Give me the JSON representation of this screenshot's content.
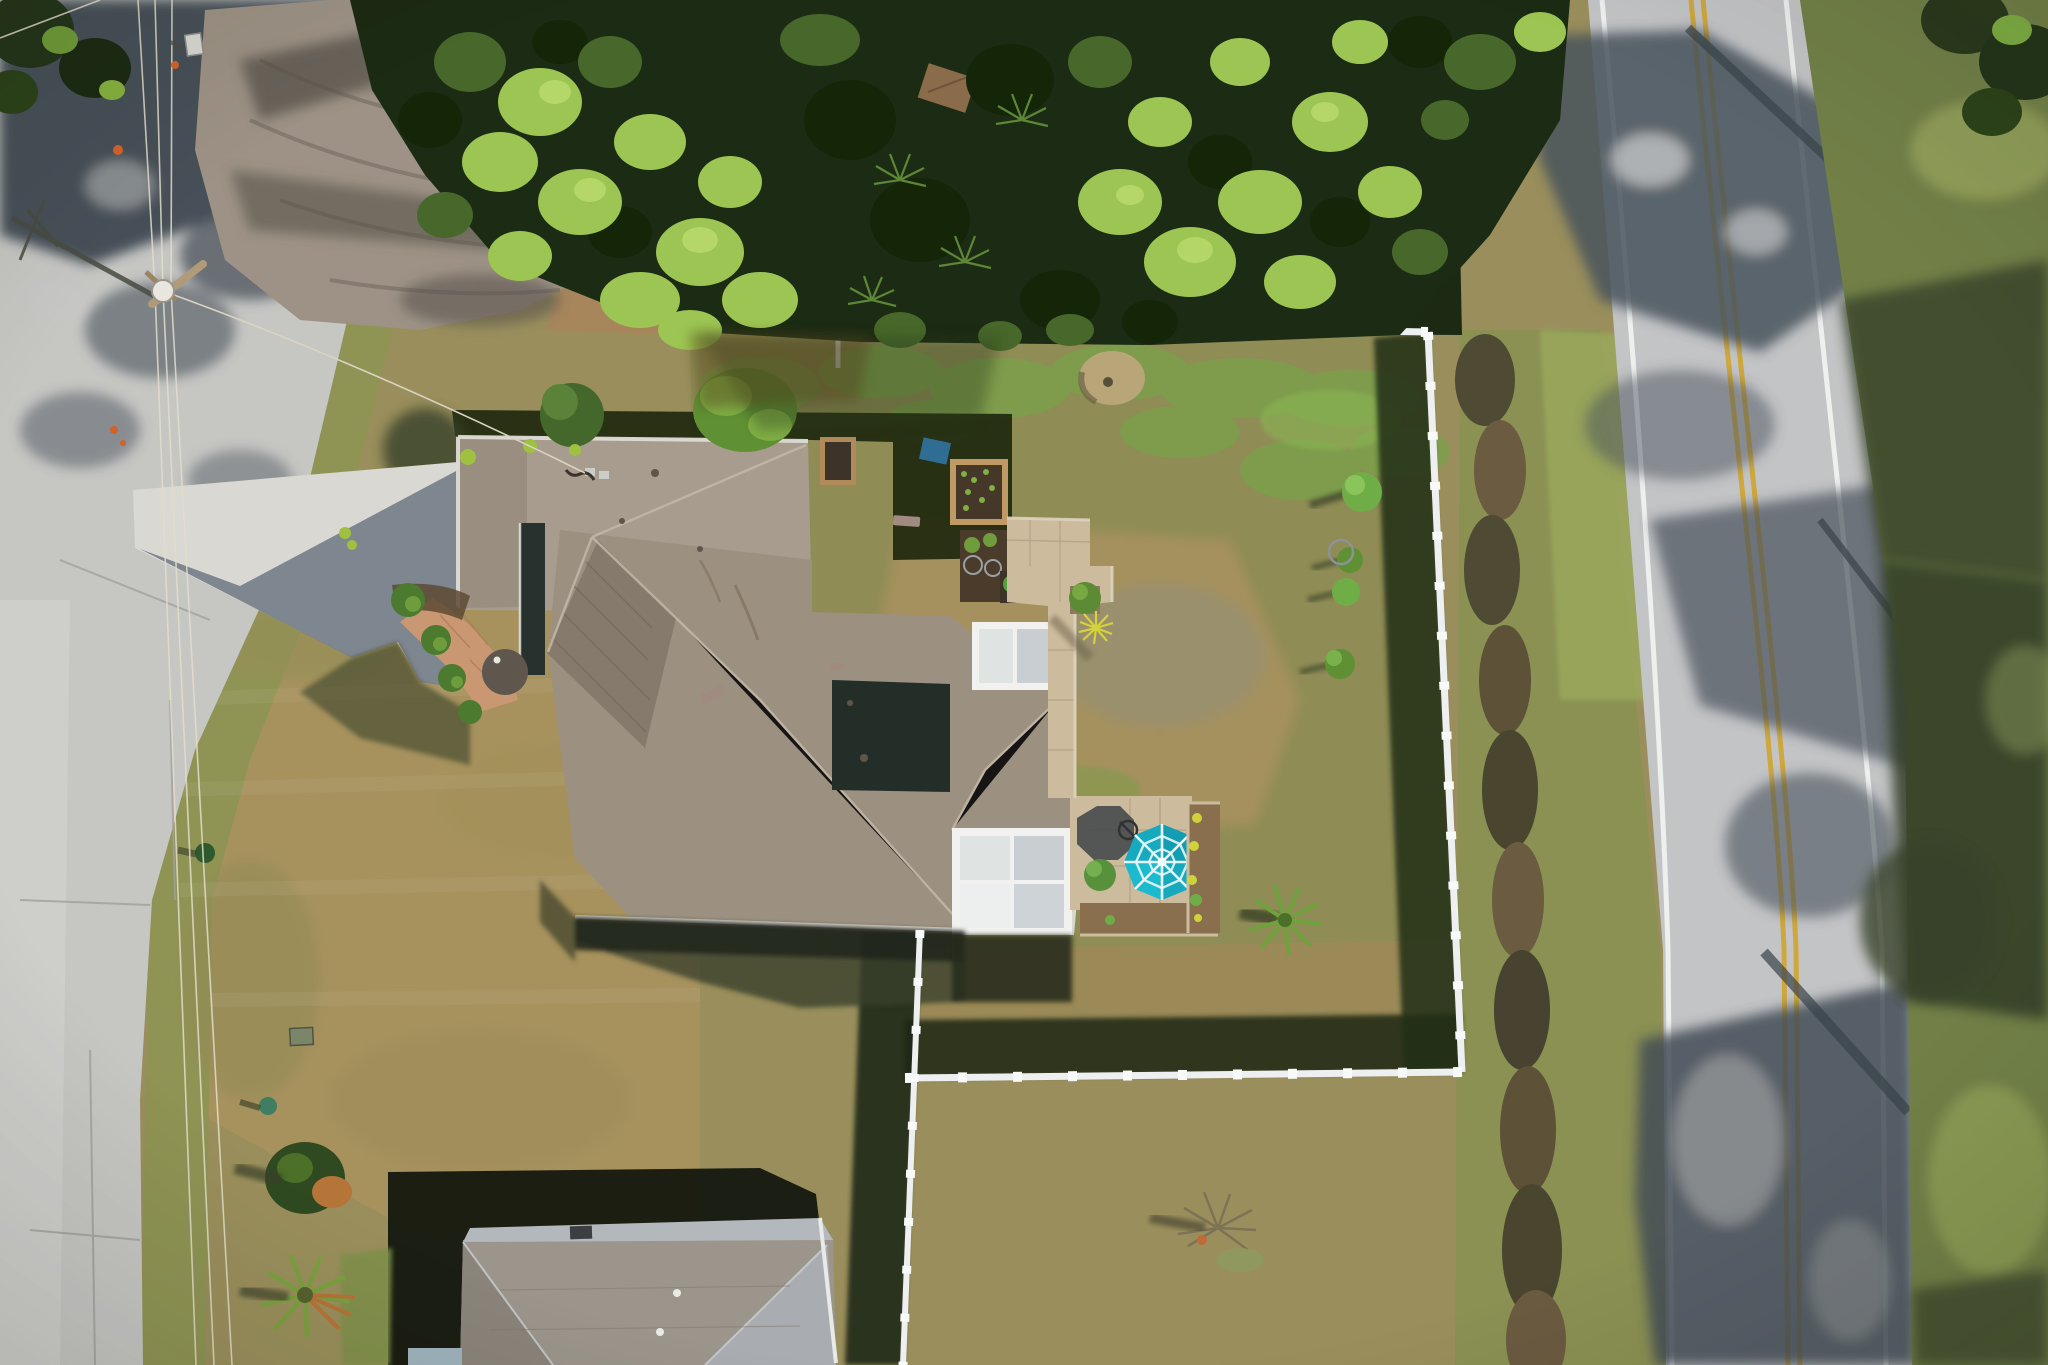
{
  "meta": {
    "kind": "aerial-drone-photo",
    "description": "Top-down aerial photo of a single-family home with tan shingle hip roof, concrete driveway to a road on the left, white vinyl-fenced backyard with paver patio and teal umbrella, dense pine/palmetto trees at top, and a second road with double yellow centerline on the right; neighboring house roof at bottom.",
    "width_px": 2048,
    "height_px": 1365
  },
  "palette": {
    "lawn_base": "#9a8f5c",
    "lawn_tan": "#a8925f",
    "lawn_olive": "#8f9454",
    "lawn_green": "#7ba04b",
    "asphalt_left": "#c6c6c3",
    "asphalt_right": "#c3c4c6",
    "road_shadow": "#49535c",
    "line_white": "#eef0ee",
    "line_yellow": "#cfa83d",
    "dirt": "#9d9285",
    "canopy_dark": "#1c2b13",
    "canopy_mid": "#47682a",
    "canopy_bright": "#9cc553",
    "roof_main": "#a79c8d",
    "roof_west": "#998e80",
    "roof_dark": "#857a6c",
    "roof_south": "#9c9081",
    "gutter": "#dcdcd6",
    "driveway": "#d9d8d2",
    "driveway_shadow": "#79828c",
    "fence": "#edeff0",
    "shadow_deep": "#11160d",
    "lanai_frame": "#f1f2f0",
    "lanai_panel": "#c9ced2",
    "paver": "#cdbb9d",
    "soil": "#8a6f4e",
    "umbrella_teal": "#17aabf",
    "neighbor_roof": "#9b958b",
    "neighbor_roof_north": "#b3b8bc"
  },
  "scene": {
    "roads": [
      {
        "name": "left-road",
        "orientation": "vertical-diagonal",
        "markings": "none",
        "condition": "cracked asphalt, tree shadows at top, utility pole shadow"
      },
      {
        "name": "right-road",
        "orientation": "vertical-diagonal",
        "markings": "double yellow centerline, white edge lines",
        "condition": "heavy tree shadows from east"
      }
    ],
    "powerlines": {
      "wires": 3,
      "pole_with_transformer": true,
      "service_drop_to_house": true
    },
    "house": {
      "roof": "tan/taupe asphalt shingle hip-and-gable",
      "driveway": "light concrete with house shadow",
      "entry_walk": "orange paver path with palmetto plants",
      "garden_beds": 4,
      "lanai_sections": 2,
      "patio": {
        "pavers": "tan",
        "umbrella": "teal with white ribs",
        "chairs": 2,
        "flowers": "yellow"
      }
    },
    "backyard": {
      "fence": "white vinyl, north-east-south-west runs",
      "small_trees_along_east_fence": 4,
      "yard_palm": true,
      "dead_bush": true,
      "sand_circle": true
    },
    "vegetation": {
      "top_band": "pines and palmettos",
      "bottom_left": "palms with dead orange fronds",
      "shed_in_trees": true
    },
    "neighbor_house": {
      "position": "bottom",
      "roof": "gray shingle hip",
      "shadow_cast": "north-west"
    }
  }
}
